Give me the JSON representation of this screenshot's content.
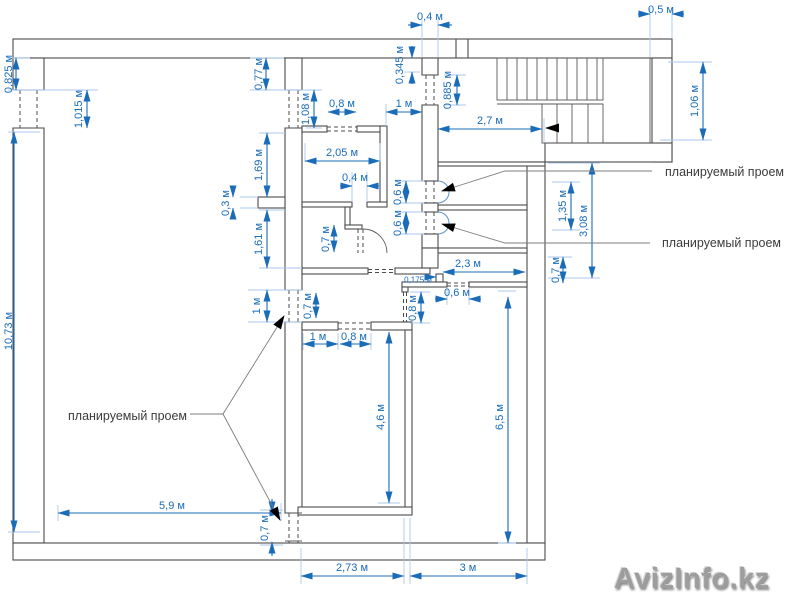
{
  "labels": {
    "planned_opening_1": "планируемый проем",
    "planned_opening_2": "планируемый проем",
    "planned_opening_3": "планируемый проем"
  },
  "dims": {
    "top_wall_thickness": "0,4 м",
    "top_right_wall": "0,5 м",
    "middle_room_top_opening": "0,8 м",
    "hall_opening": "1 м",
    "stair_hall_width": "2,7 м",
    "middle_room_width": "2,05 м",
    "bath_door_width": "0,4 м",
    "corridor_length": "2,3 м",
    "corridor_step": "0,175 м",
    "corridor_bottom_opening": "0,6 м",
    "lower_room_top_left": "1 м",
    "lower_room_top_opening": "0,8 м",
    "left_room_width": "5,9 м",
    "bottom_span_left": "2,73 м",
    "bottom_span_right": "3 м",
    "left_wall_top_offset": "0,825 м",
    "left_wall_opening": "1,015 м",
    "left_room_height": "10,73 м",
    "w1_top_offset": "0,77 м",
    "w1_opening_top": "1,08 м",
    "w1_segment_upper": "1,69 м",
    "w1_stub": "0,3 м",
    "w1_segment_lower": "1,61 м",
    "w1_opening_mid_left": "1 м",
    "stair_wall_top_offset": "0,345 м",
    "stair_wall_opening": "0,885 м",
    "stair_landing_width": "1,06 м",
    "planned_opening_upper_height": "0,6 м",
    "planned_opening_lower_height": "0,6 м",
    "bath_door_height": "0,7 м",
    "right_rooms_upper": "1,35 м",
    "right_rooms_total": "3,08 м",
    "right_rooms_lower": "0,7 м",
    "w1_opening_mid": "0,7 м",
    "corridor_south_opening": "0,8 м",
    "lower_room_height": "4,6 м",
    "right_room_height": "6,5 м",
    "bottom_opening_height": "0,7 м"
  },
  "watermark": {
    "text": "AvizInfo.kz"
  }
}
